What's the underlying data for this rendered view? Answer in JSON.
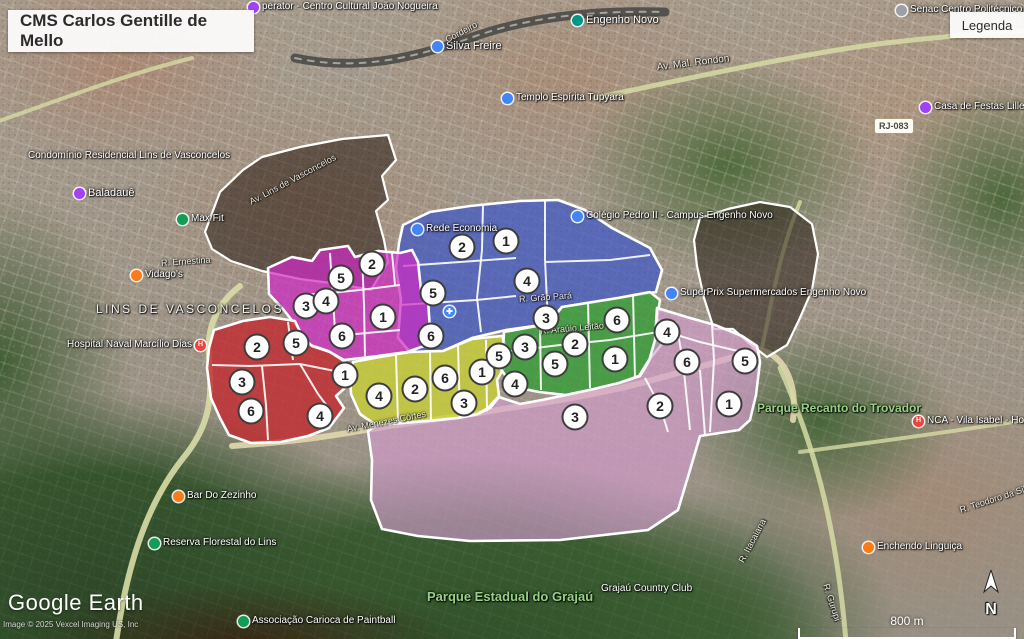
{
  "header": {
    "title": "CMS Carlos Gentille de Mello",
    "legend_button": "Legenda"
  },
  "attribution": {
    "logo_google": "Google",
    "logo_earth": "Earth",
    "copyright": "Image © 2025 Vexcel Imaging US, Inc"
  },
  "scale": {
    "label": "800 m"
  },
  "compass": {
    "label": "N"
  },
  "map": {
    "roads": [
      {
        "name": "railway-corridor",
        "d": "M 295,58 C 360,72 420,56 470,38 C 520,20 580,10 665,12",
        "color": "#4a4a48",
        "width": 9,
        "opacity": 0.9
      },
      {
        "name": "railway-ties",
        "d": "M 295,58 C 360,72 420,56 470,38 C 520,20 580,10 665,12",
        "color": "#c9c7b8",
        "width": 2,
        "opacity": 0.7,
        "dash": "6 7"
      },
      {
        "name": "road-av-mal-rondon",
        "d": "M 595,98 C 690,78 780,58 870,45 C 925,38 975,34 1026,31",
        "color": "#d6dba4",
        "width": 5,
        "opacity": 0.85
      },
      {
        "name": "road-top-left",
        "d": "M -4,122 C 60,100 120,76 192,58",
        "color": "#d6dba4",
        "width": 4,
        "opacity": 0.8
      },
      {
        "name": "road-lins-west",
        "d": "M 116,642 C 128,560 148,502 184,457 C 214,420 211,392 209,356 C 206,322 222,300 240,286",
        "color": "#d8dda6",
        "width": 6,
        "opacity": 0.9
      },
      {
        "name": "road-menezes-cortes",
        "d": "M 232,446 C 320,440 356,431 396,425 C 450,417 478,414 502,409 C 560,401 618,390 656,379 C 700,367 732,358 758,349 C 788,356 797,388 793,420",
        "color": "#ddd3ac",
        "width": 6,
        "opacity": 0.95
      },
      {
        "name": "road-right-north",
        "d": "M 762,348 C 772,300 780,250 800,202",
        "color": "#d6dba4",
        "width": 4,
        "opacity": 0.8
      },
      {
        "name": "road-right-south",
        "d": "M 780,368 C 812,440 836,520 846,642",
        "color": "#d6dba4",
        "width": 5,
        "opacity": 0.85
      },
      {
        "name": "road-right-cross",
        "d": "M 1026,420 C 950,432 876,442 800,452",
        "color": "#d6dba4",
        "width": 4,
        "opacity": 0.8
      }
    ],
    "dark_zones": [
      {
        "name": "dark-northwest",
        "color": "#1d120c",
        "opacity": 0.5,
        "points": "205,232 220,192 243,170 262,157 300,147 342,139 388,135 396,160 382,176 388,200 376,211 384,240 388,262 371,290 338,284 300,279 262,271 231,261 212,249"
      },
      {
        "name": "dark-east",
        "color": "#1d120c",
        "opacity": 0.5,
        "points": "700,218 728,209 760,202 790,207 812,224 818,254 812,290 799,320 787,345 767,357 750,344 733,329 714,329 704,298 697,266 694,240"
      }
    ],
    "regions": [
      {
        "name": "blue",
        "color": "#3c55c8",
        "opacity": 0.7,
        "points": "403,225 430,212 470,206 520,201 558,200 585,210 612,228 650,248 662,270 656,292 618,298 562,307 548,324 506,330 472,338 443,351 410,352 398,338 401,300 396,268 399,243",
        "lines": [
          "483,205 482,250 477,298 481,332",
          "545,201 545,260 548,322",
          "403,266 460,262 516,258",
          "545,262 610,260 650,255",
          "400,305 476,300 516,296"
        ],
        "markers": [
          {
            "n": "1",
            "x": 506,
            "y": 241
          },
          {
            "n": "2",
            "x": 462,
            "y": 247
          },
          {
            "n": "3",
            "x": 546,
            "y": 318
          },
          {
            "n": "4",
            "x": 527,
            "y": 281
          },
          {
            "n": "5",
            "x": 433,
            "y": 293
          },
          {
            "n": "6",
            "x": 431,
            "y": 336
          }
        ]
      },
      {
        "name": "magenta",
        "color": "#cf2bc4",
        "opacity": 0.72,
        "points": "268,268 292,257 312,261 320,250 348,246 355,257 378,251 400,253 412,250 418,262 421,290 428,300 430,330 424,346 407,352 378,356 344,360 328,351 307,344 298,328 283,309 269,294",
        "lines": [
          "330,253 333,300 336,345",
          "362,254 364,305 365,356",
          "300,295 330,293 360,290 400,285",
          "392,253 395,285",
          "345,335 400,330"
        ],
        "markers": [
          {
            "n": "1",
            "x": 383,
            "y": 317
          },
          {
            "n": "2",
            "x": 372,
            "y": 264
          },
          {
            "n": "3",
            "x": 306,
            "y": 306
          },
          {
            "n": "4",
            "x": 326,
            "y": 301
          },
          {
            "n": "5",
            "x": 341,
            "y": 278
          },
          {
            "n": "6",
            "x": 342,
            "y": 336
          }
        ]
      },
      {
        "name": "red",
        "color": "#c3272b",
        "opacity": 0.78,
        "points": "214,330 243,321 270,317 295,321 302,336 312,346 330,352 344,361 352,372 347,386 336,396 344,408 329,428 308,436 281,442 251,443 229,435 220,418 211,398 207,368 209,348",
        "lines": [
          "288,322 293,360",
          "212,365 250,366 300,364 340,372",
          "262,366 266,405 268,440",
          "300,364 318,394 330,410"
        ],
        "markers": [
          {
            "n": "1",
            "x": 345,
            "y": 375
          },
          {
            "n": "2",
            "x": 257,
            "y": 347
          },
          {
            "n": "3",
            "x": 242,
            "y": 382
          },
          {
            "n": "4",
            "x": 320,
            "y": 416
          },
          {
            "n": "5",
            "x": 296,
            "y": 343
          },
          {
            "n": "6",
            "x": 251,
            "y": 411
          }
        ]
      },
      {
        "name": "yellow",
        "color": "#c8cf36",
        "opacity": 0.8,
        "points": "353,362 380,357 410,352 443,351 472,339 502,336 508,352 504,368 497,380 499,396 488,408 476,415 458,418 428,421 398,423 376,425 360,414 351,394 350,376",
        "lines": [
          "396,355 398,422",
          "430,352 431,420",
          "458,345 460,417",
          "486,340 487,412"
        ],
        "markers": [
          {
            "n": "1",
            "x": 482,
            "y": 372
          },
          {
            "n": "2",
            "x": 415,
            "y": 389
          },
          {
            "n": "3",
            "x": 464,
            "y": 403
          },
          {
            "n": "4",
            "x": 379,
            "y": 396
          },
          {
            "n": "5",
            "x": 499,
            "y": 356
          },
          {
            "n": "6",
            "x": 445,
            "y": 378
          }
        ]
      },
      {
        "name": "green",
        "color": "#2f9e33",
        "opacity": 0.75,
        "points": "504,332 548,324 562,307 618,298 650,292 660,300 657,318 664,330 661,345 649,360 639,376 619,383 594,389 566,395 539,392 519,388 508,379 500,368 503,350",
        "lines": [
          "540,325 541,390",
          "588,302 590,388",
          "633,295 635,378",
          "503,352 560,345 610,340 658,332"
        ],
        "markers": [
          {
            "n": "1",
            "x": 615,
            "y": 359
          },
          {
            "n": "2",
            "x": 575,
            "y": 344
          },
          {
            "n": "3",
            "x": 525,
            "y": 347
          },
          {
            "n": "4",
            "x": 515,
            "y": 384
          },
          {
            "n": "5",
            "x": 555,
            "y": 364
          },
          {
            "n": "6",
            "x": 617,
            "y": 320
          }
        ]
      },
      {
        "name": "pink",
        "color": "#d79cd2",
        "opacity": 0.62,
        "points": "657,308 690,318 715,325 742,336 757,346 760,362 756,395 750,420 739,430 700,436 690,470 678,510 648,530 560,540 470,541 418,536 382,529 371,500 372,460 368,431 377,425 428,421 458,418 478,414 490,408 499,397 520,404 542,400 566,395 594,389 619,383 640,376 649,361 655,340",
        "lines": [
          "676,322 683,362 690,430",
          "712,325 714,360 710,432",
          "660,330 700,342 742,352",
          "700,370 705,435",
          "645,378 660,406 668,432"
        ],
        "markers": [
          {
            "n": "1",
            "x": 729,
            "y": 404
          },
          {
            "n": "2",
            "x": 660,
            "y": 406
          },
          {
            "n": "3",
            "x": 575,
            "y": 417
          },
          {
            "n": "4",
            "x": 667,
            "y": 332
          },
          {
            "n": "5",
            "x": 745,
            "y": 361
          },
          {
            "n": "6",
            "x": 687,
            "y": 362
          }
        ]
      }
    ],
    "labels": [
      {
        "text": "perator - Centro Cultural João Nogueira",
        "x": 248,
        "y": 1,
        "pin": "purple",
        "size": 10
      },
      {
        "text": "Senac Centro Politécnico",
        "x": 896,
        "y": 4,
        "pin": "gray",
        "size": 10
      },
      {
        "text": "Engenho Novo",
        "x": 572,
        "y": 14,
        "pin": "teal",
        "size": 11
      },
      {
        "text": "Silva Freire",
        "x": 432,
        "y": 40,
        "pin": "blue",
        "size": 11
      },
      {
        "text": "Cordeiro",
        "x": 446,
        "y": 34,
        "type": "street",
        "rotate": -28,
        "size": 9
      },
      {
        "text": "Av. Mal. Rondon",
        "x": 657,
        "y": 62,
        "type": "street",
        "rotate": -7,
        "size": 10
      },
      {
        "text": "Templo Espírita Tupyara",
        "x": 502,
        "y": 92,
        "pin": "blue",
        "size": 10
      },
      {
        "text": "Casa de Festas Lille",
        "x": 920,
        "y": 101,
        "pin": "purple",
        "size": 10
      },
      {
        "text": "RJ-083",
        "x": 874,
        "y": 118,
        "type": "badge"
      },
      {
        "text": "Condomínio Residencial Lins de Vasconcelos",
        "x": 28,
        "y": 150,
        "size": 10
      },
      {
        "text": "Av. Lins de Vasconcelos",
        "x": 250,
        "y": 196,
        "type": "street",
        "rotate": -28,
        "size": 9
      },
      {
        "text": "Baladauê",
        "x": 74,
        "y": 187,
        "pin": "purple",
        "size": 11
      },
      {
        "text": "Max Fit",
        "x": 177,
        "y": 213,
        "pin": "green",
        "size": 10
      },
      {
        "text": "Colégio Pedro II - Campus Engenho Novo",
        "x": 572,
        "y": 210,
        "pin": "blue",
        "size": 10
      },
      {
        "text": "Rede Economia",
        "x": 412,
        "y": 223,
        "pin": "blue",
        "size": 10
      },
      {
        "text": "R. Ernestina",
        "x": 161,
        "y": 257,
        "type": "street",
        "rotate": -4,
        "size": 9
      },
      {
        "text": "Vidago's",
        "x": 131,
        "y": 269,
        "pin": "orange",
        "size": 10
      },
      {
        "text": "SuperPrix Supermercados Engenho Novo",
        "x": 666,
        "y": 287,
        "pin": "blue",
        "size": 10
      },
      {
        "text": "R. Grão Pará",
        "x": 519,
        "y": 293,
        "type": "street",
        "rotate": -4,
        "size": 9
      },
      {
        "text": "LINS DE VASCONCELOS",
        "x": 96,
        "y": 303,
        "type": "district",
        "size": 12
      },
      {
        "text": "",
        "x": 444,
        "y": 306,
        "pin": "med"
      },
      {
        "text": "R. Araújo Leitão",
        "x": 540,
        "y": 325,
        "type": "street",
        "rotate": -5,
        "size": 9
      },
      {
        "text": "Hospital Naval Marcílio Dias",
        "x": 67,
        "y": 339,
        "pin": "red-h",
        "pin_pos": "right",
        "size": 10
      },
      {
        "text": "Parque Recanto do Trovador",
        "x": 757,
        "y": 402,
        "type": "park",
        "size": 12
      },
      {
        "text": "NCA - Vila Isabel - Hospital",
        "x": 913,
        "y": 415,
        "pin": "red-h",
        "size": 10
      },
      {
        "text": "Av. Menezes Côrtes",
        "x": 347,
        "y": 423,
        "type": "street",
        "rotate": -11,
        "size": 9
      },
      {
        "text": "Bar Do Zezinho",
        "x": 173,
        "y": 490,
        "pin": "orange",
        "size": 10
      },
      {
        "text": "R. Teodoro da Silva",
        "x": 960,
        "y": 504,
        "type": "street",
        "rotate": -18,
        "size": 9
      },
      {
        "text": "R. Itacaiana",
        "x": 741,
        "y": 556,
        "type": "street",
        "rotate": -62,
        "size": 9
      },
      {
        "text": "Reserva Florestal do Lins",
        "x": 149,
        "y": 537,
        "pin": "green",
        "size": 10
      },
      {
        "text": "Enchendo Linguiça",
        "x": 863,
        "y": 541,
        "pin": "orange",
        "size": 10
      },
      {
        "text": "R. Gurupi",
        "x": 826,
        "y": 578,
        "type": "street",
        "rotate": 72,
        "size": 9
      },
      {
        "text": "Grajaú Country Club",
        "x": 601,
        "y": 583,
        "size": 10
      },
      {
        "text": "Parque Estadual do Grajaú",
        "x": 427,
        "y": 591,
        "type": "park",
        "size": 13
      },
      {
        "text": "Associação Carioca de Paintball",
        "x": 238,
        "y": 615,
        "pin": "green",
        "size": 10
      }
    ]
  }
}
